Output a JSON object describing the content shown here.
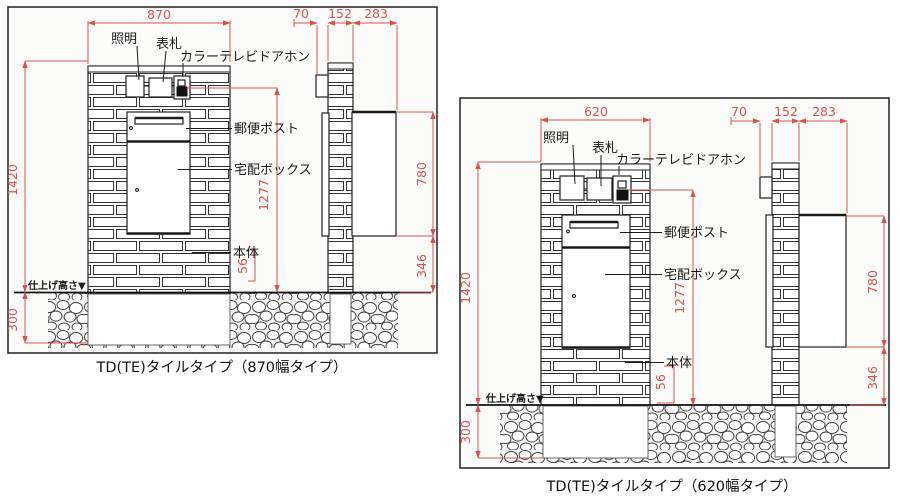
{
  "drawing_type": "dimension-diagram",
  "colors": {
    "dimension_red": "#d9534e",
    "line_black": "#1a1a1a",
    "panel_bg": "#fbfbfa"
  },
  "panels": [
    {
      "caption": "TD(TE)タイルタイプ（870幅タイプ）",
      "labels": {
        "lighting": "照明",
        "nameplate": "表札",
        "doorphone": "カラーテレビドアホン",
        "mail_post": "郵便ポスト",
        "delivery_box": "宅配ボックス",
        "body": "本体",
        "finish_height": "仕上げ高さ▼"
      },
      "dims": {
        "width": "870",
        "total_height": "1420",
        "doorphone_height": "1277",
        "body_clearance": "56",
        "underground_depth": "300",
        "side_offset": "70",
        "side_width": "152",
        "side_depth": "283",
        "box_height": "780",
        "box_bottom_height": "346"
      }
    },
    {
      "caption": "TD(TE)タイルタイプ（620幅タイプ）",
      "labels": {
        "lighting": "照明",
        "nameplate": "表札",
        "doorphone": "カラーテレビドアホン",
        "mail_post": "郵便ポスト",
        "delivery_box": "宅配ボックス",
        "body": "本体",
        "finish_height": "仕上げ高さ▼"
      },
      "dims": {
        "width": "620",
        "total_height": "1420",
        "doorphone_height": "1277",
        "body_clearance": "56",
        "underground_depth": "300",
        "side_offset": "70",
        "side_width": "152",
        "side_depth": "283",
        "box_height": "780",
        "box_bottom_height": "346"
      }
    }
  ]
}
